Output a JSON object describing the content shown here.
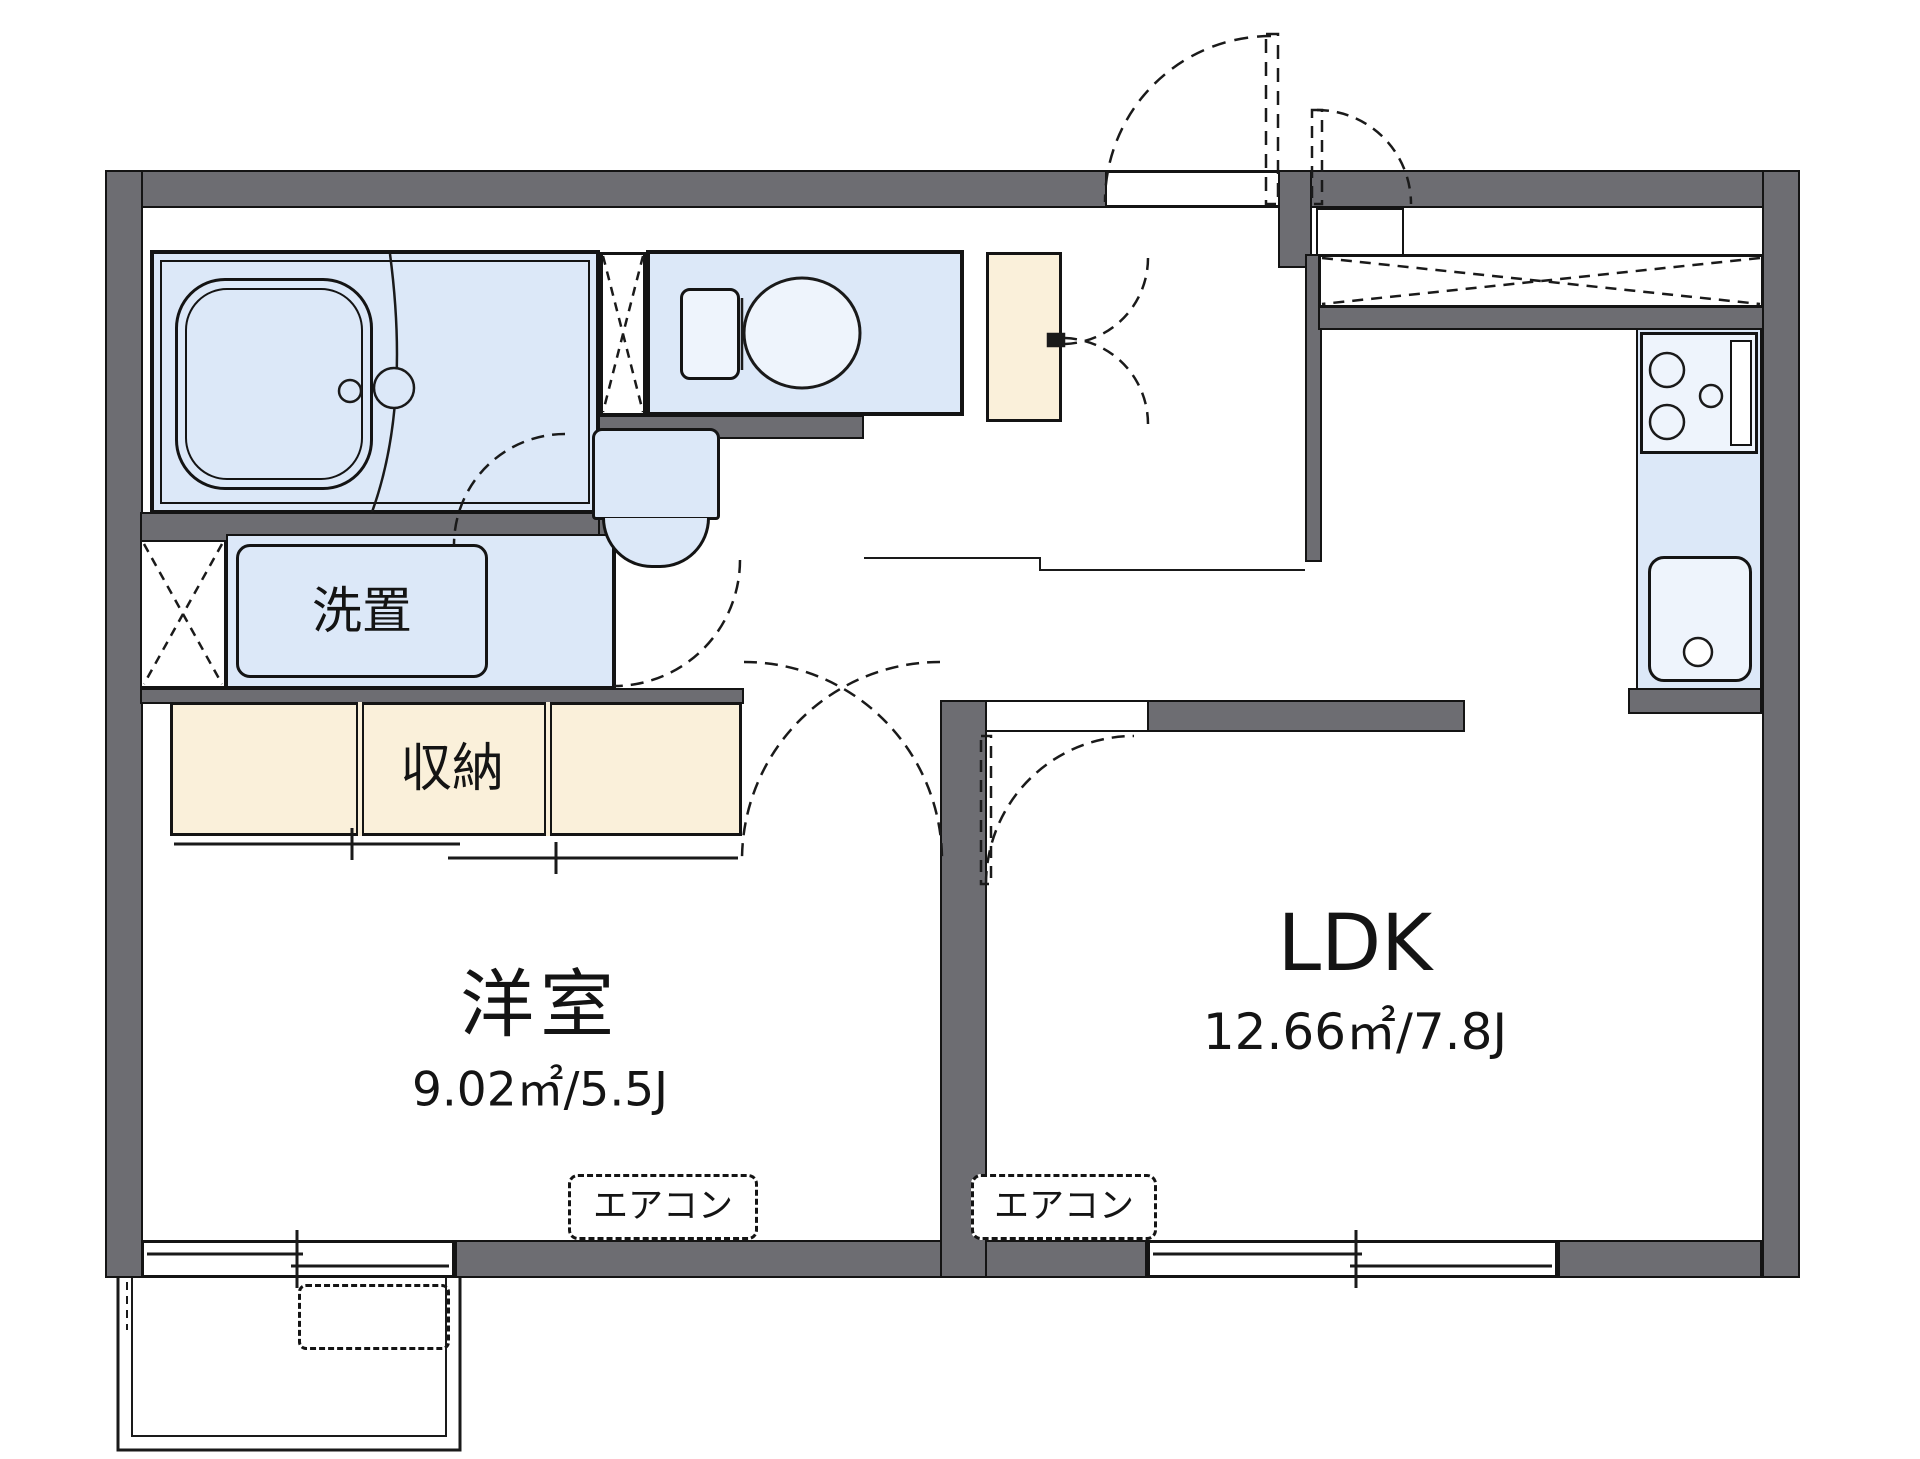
{
  "plan": {
    "rooms": {
      "western_room": {
        "label": "洋室",
        "size": "9.02㎡/5.5J"
      },
      "ldk": {
        "label": "LDK",
        "size": "12.66㎡/7.8J"
      },
      "closet": {
        "label": "収納"
      },
      "laundry": {
        "label": "洗置"
      }
    },
    "equipment": {
      "aircon_1": "エアコン",
      "aircon_2": "エアコン"
    },
    "colors": {
      "wall": "#6d6d72",
      "room_fill": "#dce8f8",
      "fixture_fill": "#eef4fc",
      "storage_fill": "#faf0da",
      "line": "#1a1a1a"
    }
  }
}
